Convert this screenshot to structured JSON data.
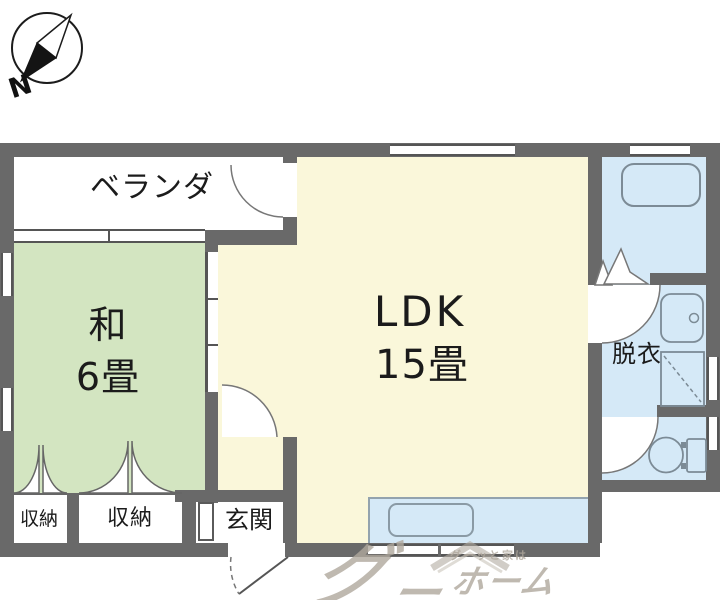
{
  "compass": {
    "direction_label": "N",
    "icon": "compass-icon"
  },
  "rooms": {
    "veranda": {
      "label": "ベランダ"
    },
    "washitsu": {
      "name": "和",
      "size": "6畳"
    },
    "ldk": {
      "name": "LDK",
      "size": "15畳"
    },
    "datsui": {
      "label": "脱衣"
    },
    "closet_left": {
      "label": "収納"
    },
    "closet_right": {
      "label": "収納"
    },
    "genkan": {
      "label": "玄関"
    }
  },
  "fixtures": {
    "bathtub": "bathtub-icon",
    "wash_basin": "wash-basin-icon",
    "washer_space": "washing-machine-space-icon",
    "toilet": "toilet-icon",
    "kitchen_sink": "kitchen-sink-icon"
  },
  "watermark": {
    "brand_main": "グ",
    "brand_dash": "ー",
    "brand_home": "ホーム",
    "tagline": "グーッと家は"
  },
  "palette": {
    "wall": "#696969",
    "tatami_green": "#d3e5c1",
    "ldk_cream": "#faf7da",
    "wet_area_blue": "#d5e9f7",
    "fixture_line": "#7c8b96",
    "text": "#1b1b1b",
    "watermark_gray": "#b0a89d"
  }
}
